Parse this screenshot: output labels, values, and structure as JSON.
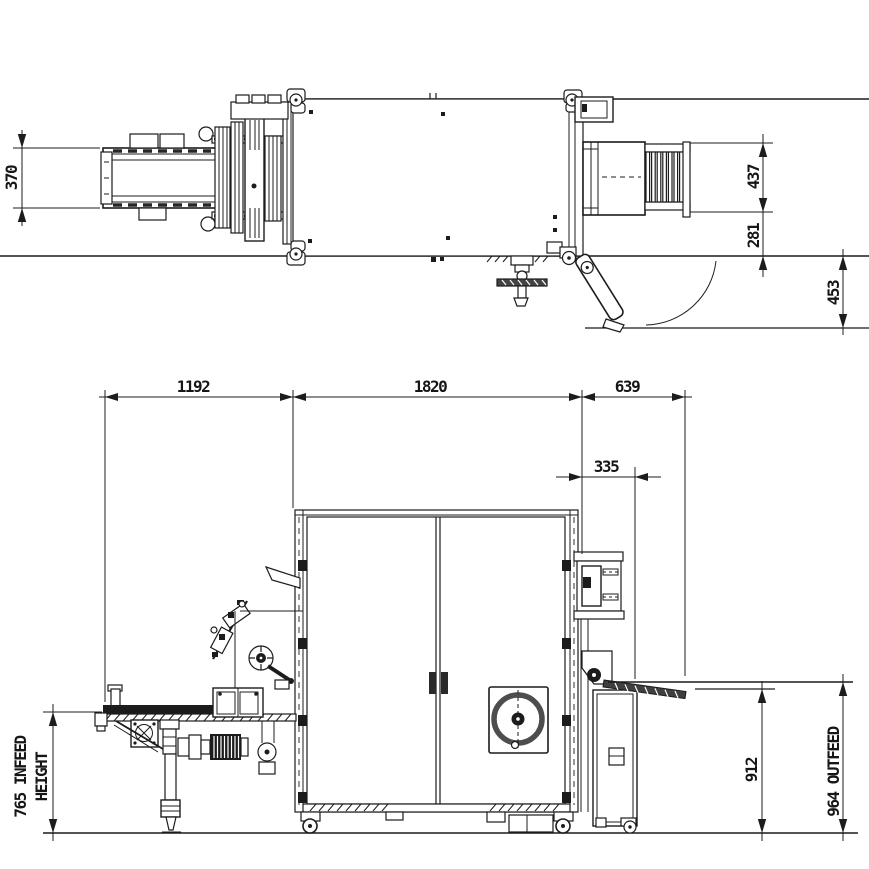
{
  "page": {
    "background": "#ffffff",
    "ink": "#1c1c1c",
    "description": "Two-view engineering layout drawing of a packaging machine"
  },
  "views": {
    "plan": {
      "label": "top-plan-view",
      "dimensions": {
        "infeed_belt_width": "370",
        "outfeed_width": "437",
        "outfeed_offset": "281",
        "door_clearance": "453"
      }
    },
    "elevation": {
      "label": "front-elevation-view",
      "dimensions": {
        "infeed_length": "1192",
        "machine_length": "1820",
        "outfeed_length": "639",
        "outfeed_stand_depth": "335",
        "outfeed_table_height": "912",
        "infeed_height_line1": "765 INFEED",
        "infeed_height_line2": "HEIGHT",
        "outfeed_height_label": "964 OUTFEED"
      }
    }
  }
}
